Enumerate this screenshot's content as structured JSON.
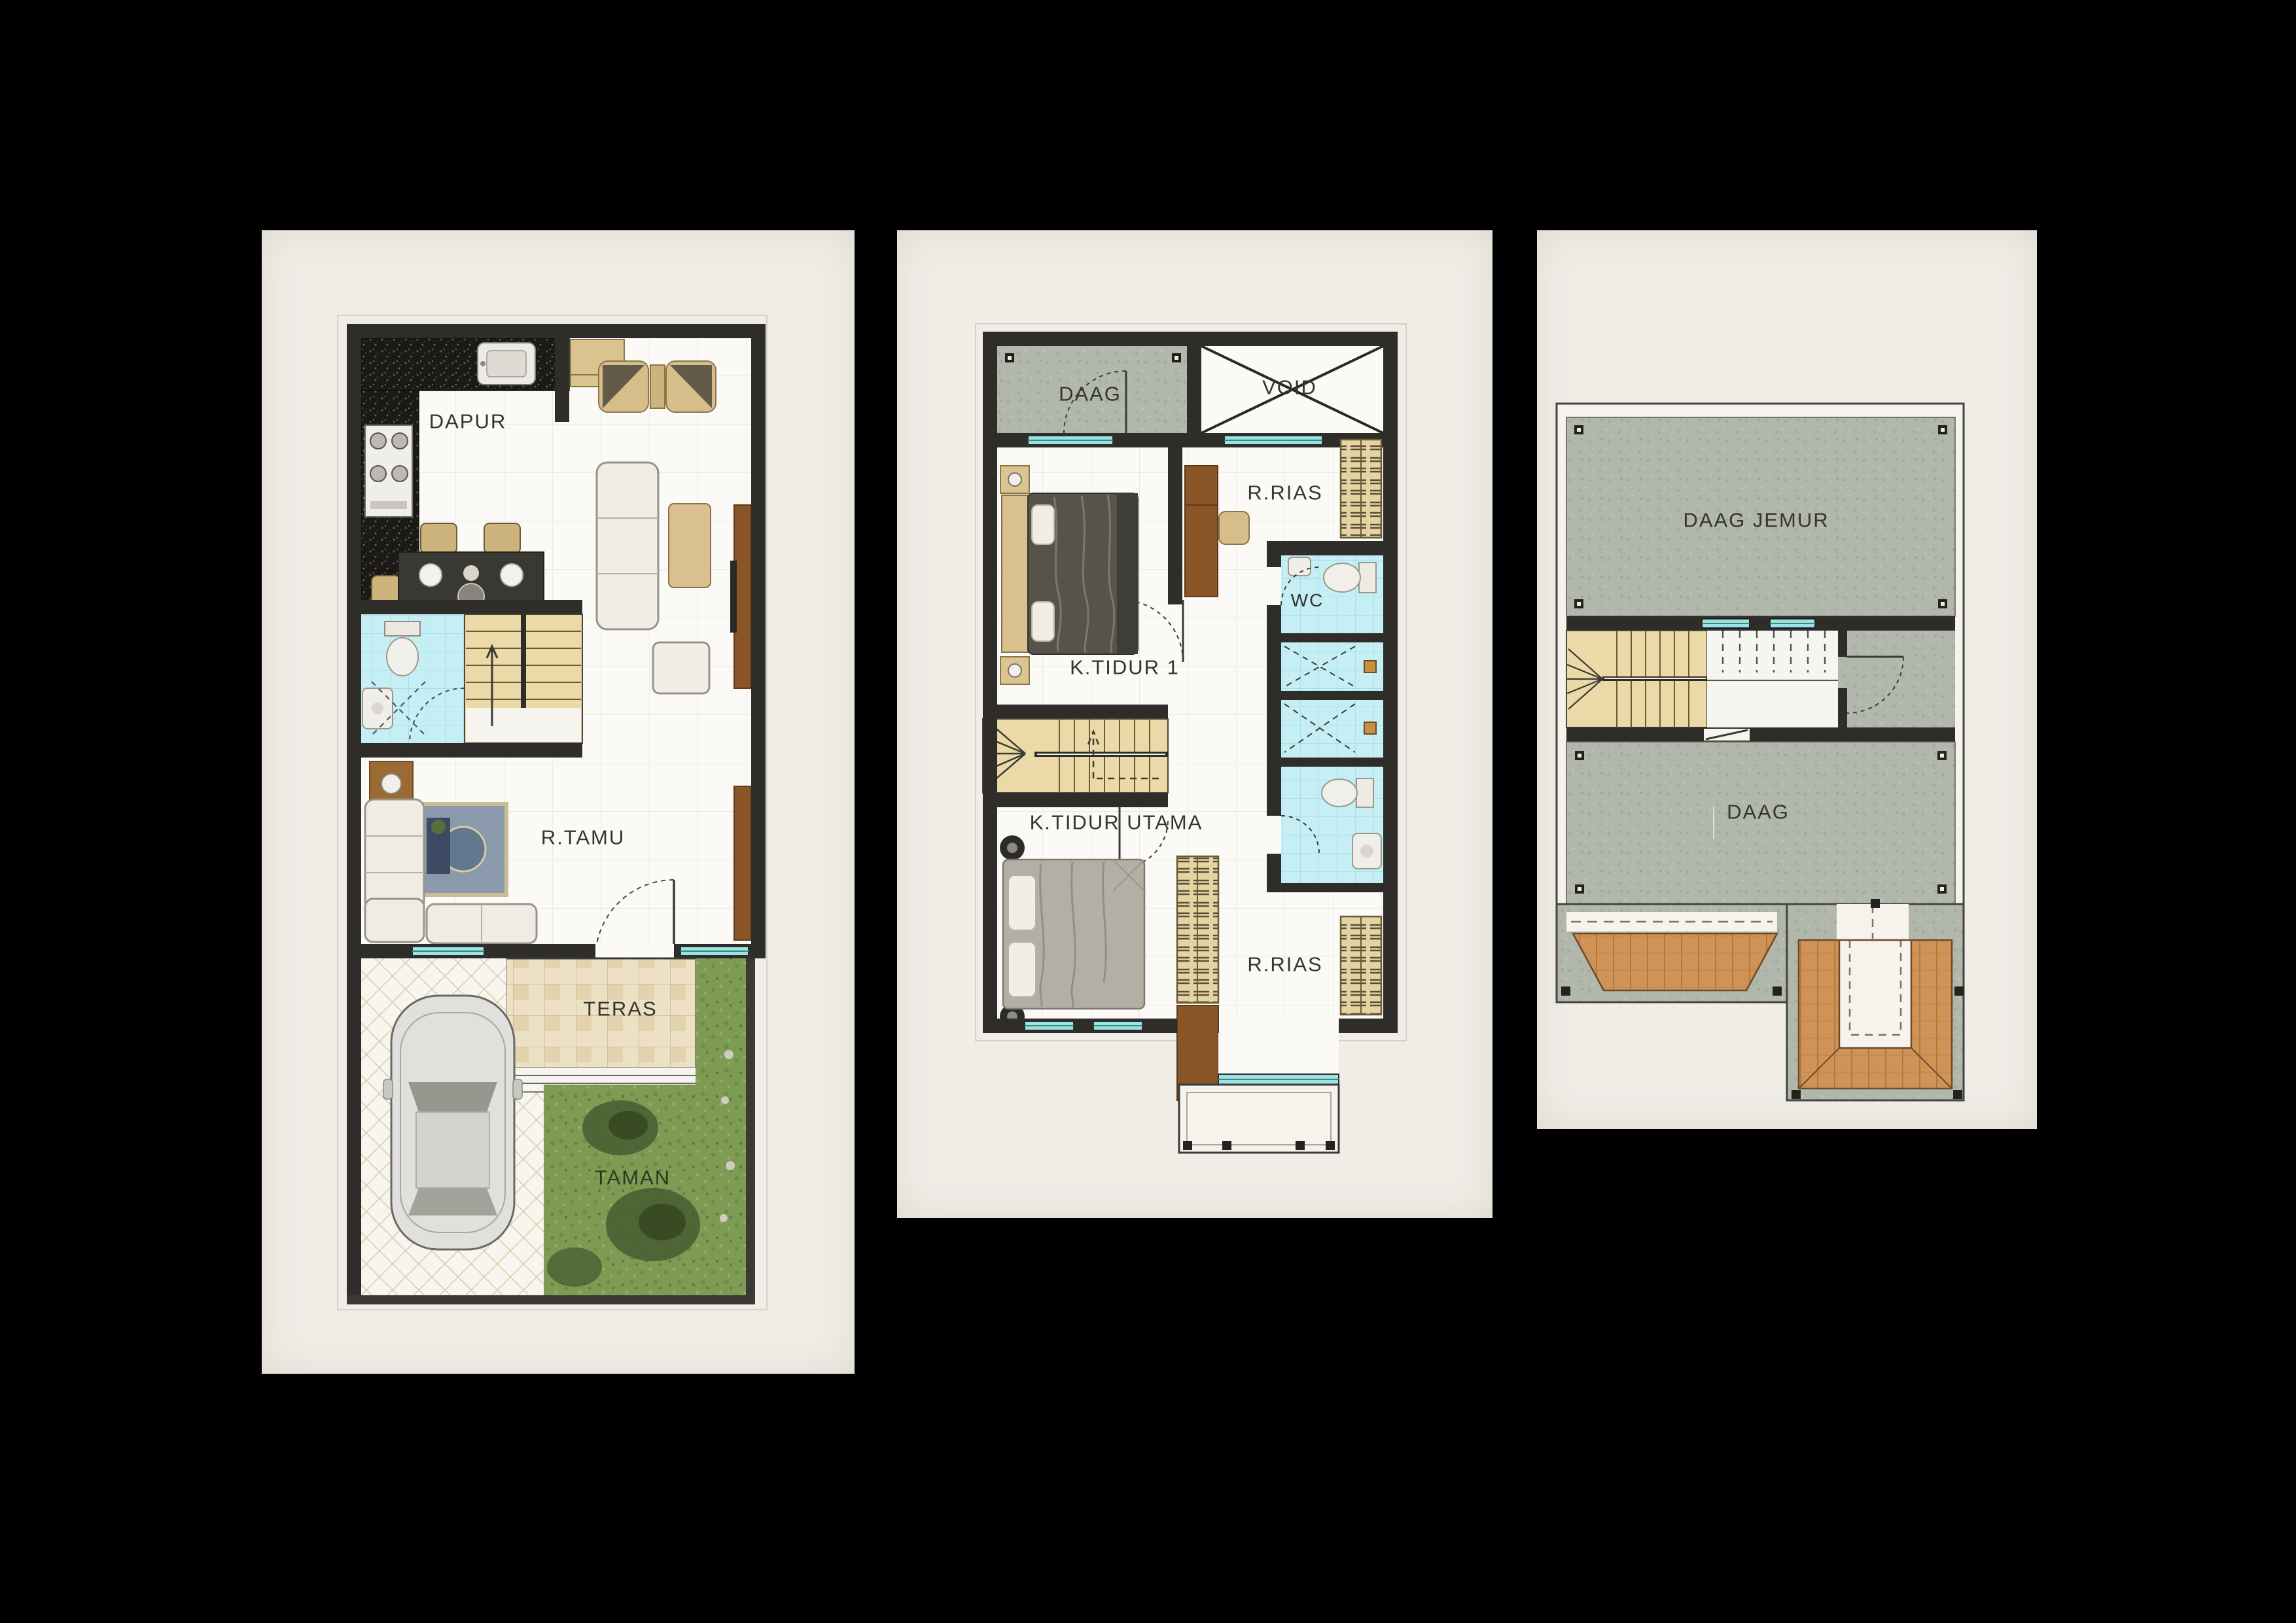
{
  "page": {
    "background": "#000000",
    "panel_background": "#f0ede7"
  },
  "colors": {
    "wall": "#2e2d29",
    "floor_white": "#fbfaf7",
    "bathroom_tile_cyan": "#c5eff4",
    "stair_wood_tan": "#ecd9a8",
    "furniture_wood_brown": "#8a5527",
    "wardrobe_tan": "#e6d3a2",
    "concrete_gray": "#b2b7ac",
    "garden_green": "#7e9b54",
    "teras_tile": "#ece1c4",
    "roof_wood": "#cf9257",
    "window_cyan": "#9ae2ec",
    "label_text": "#35342f"
  },
  "panels": [
    {
      "id": "ground-floor",
      "labels": {
        "dapur": "DAPUR",
        "r_tamu": "R.TAMU",
        "teras": "TERAS",
        "taman": "TAMAN"
      }
    },
    {
      "id": "second-floor",
      "labels": {
        "daag": "DAAG",
        "void": "VOID",
        "r_rias_1": "R.RIAS",
        "k_tidur_1": "K.TIDUR 1",
        "wc": "WC",
        "k_tidur_utama": "K.TIDUR UTAMA",
        "r_rias_2": "R.RIAS"
      }
    },
    {
      "id": "roof-plan",
      "labels": {
        "daag_jemur": "DAAG JEMUR",
        "daag": "DAAG"
      }
    }
  ]
}
